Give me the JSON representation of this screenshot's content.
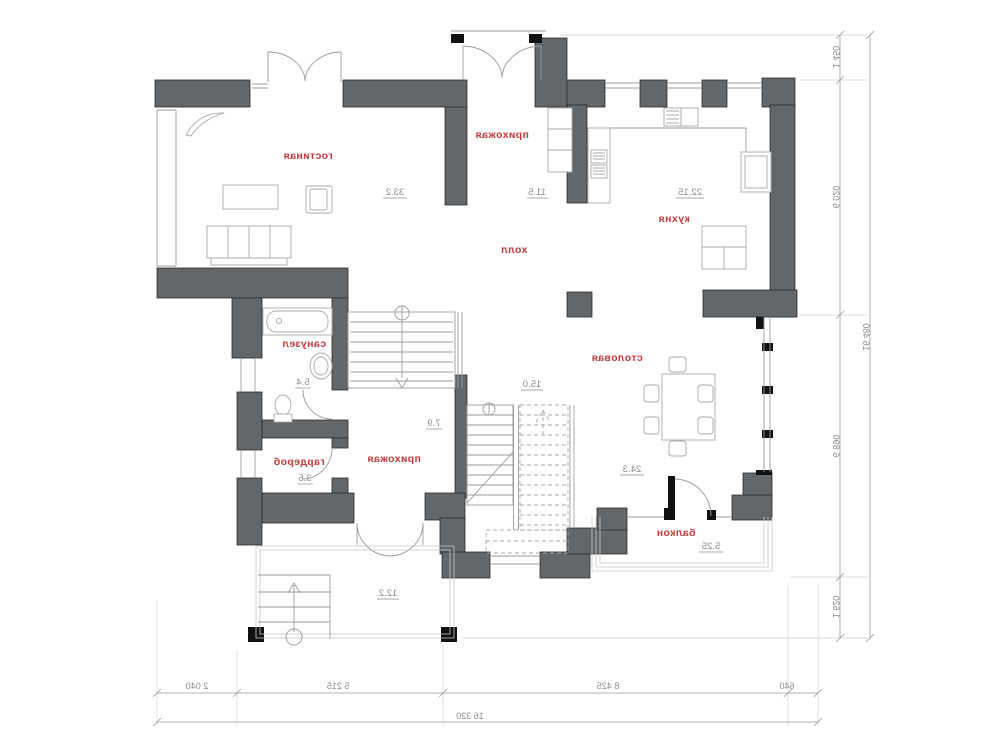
{
  "title": "Mirrored first-floor plan",
  "rooms": {
    "living": {
      "name": "гостиная",
      "area": "33.2"
    },
    "hallway_top": {
      "name": "прихожая",
      "area": "11.5"
    },
    "kitchen": {
      "name": "кухня",
      "area": "22.15"
    },
    "hall": {
      "name": "холл",
      "area": "15.0"
    },
    "bathroom": {
      "name": "санузел",
      "area": "5.4"
    },
    "wardrobe": {
      "name": "гардероб",
      "area": "3.5"
    },
    "hallway_bottom": {
      "name": "прихожая",
      "area": "7.9"
    },
    "dining": {
      "name": "столовая",
      "area": "24.3"
    },
    "balcony": {
      "name": "балкон",
      "area": "5.25"
    },
    "terrace": {
      "area": "12.2"
    }
  },
  "dimensions": {
    "bottom": [
      "2 040",
      "5 215",
      "8 425",
      "640"
    ],
    "bottom_total": "16 320",
    "right": [
      "1 450",
      "6 020",
      "6 890",
      "1 620"
    ],
    "right_total": "16 480"
  },
  "colors": {
    "wall": "#63676a",
    "label": "#c23b3b",
    "dim": "#8c8c8c",
    "furn": "#a9a9a9",
    "bg": "#ffffff"
  }
}
